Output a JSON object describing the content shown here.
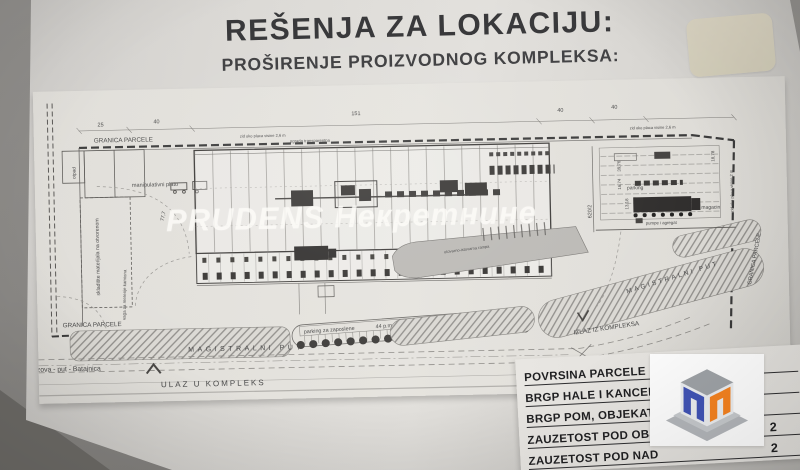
{
  "photo": {
    "title_line1": "REŠENJA ZA LOKACIJU:",
    "title_line2": "PROŠIRENJE PROIZVODNOG KOMPLEKSA:",
    "watermark": "PRUDENS Некретнине"
  },
  "plan": {
    "granica_top": "GRANICA PARCELE",
    "granica_bottom": "GRANICA PARCELE",
    "granica_right": "GRANICA PARCELE",
    "manipulativni_plato": "manipulativni plato",
    "ograda": "ograda transparentna",
    "zid_a": "zid oko placa visine 2,6 m",
    "zid_b": "zid oko placa visine 2,6 m",
    "zid_right": "zid oko placa visine 2 m",
    "otpad": "otpad",
    "skladiste": "skladište materijala na otvorenom",
    "vaga": "vaga za merenje kamiona",
    "interna": "interna saobraćajnica",
    "parking_label": "parking za zaposlene",
    "parking_count": "44 p.m.",
    "parking_small": "10 p.m.",
    "rampa": "utovarno-istovarna rampa",
    "parking_right": "parking",
    "magacin": "magacin",
    "agregat": "pumpe i agregat",
    "magistralni_a": "MAGISTRALNI PUT",
    "magistralni_b": "MAGISTRALNI PUT",
    "pazova": "Pazova - put - Batajnica",
    "ulaz": "ULAZ U KOMPLEKS",
    "izlaz": "IZLAZ IZ KOMPLEKSA",
    "parcel_id": "620/2",
    "dims": {
      "d1": "25",
      "d2": "40",
      "d3": "151",
      "d4": "40",
      "d5": "40",
      "d6": "77,7",
      "d7": "39,76",
      "d8": "16,74",
      "d9": "13,18",
      "d10": "18,78"
    }
  },
  "table": {
    "rows": [
      {
        "label": "POVRSINA PARCELE",
        "value": ""
      },
      {
        "label": "BRGP HALE I KANCEL",
        "value": ""
      },
      {
        "label": "BRGP POM, OBJEKAT",
        "value": ""
      },
      {
        "label": "ZAUZETOST POD OBJ",
        "value": "2"
      },
      {
        "label": "ZAUZETOST POD NAD",
        "value": "2"
      }
    ]
  },
  "logo": {
    "name": "prudens-cube-logo",
    "blue": "#4053b5",
    "orange": "#f58220",
    "gray": "#9ea2a6"
  },
  "colors": {
    "paper": "#e0ded9",
    "surface": "#8b8986",
    "ink": "#39393b"
  }
}
